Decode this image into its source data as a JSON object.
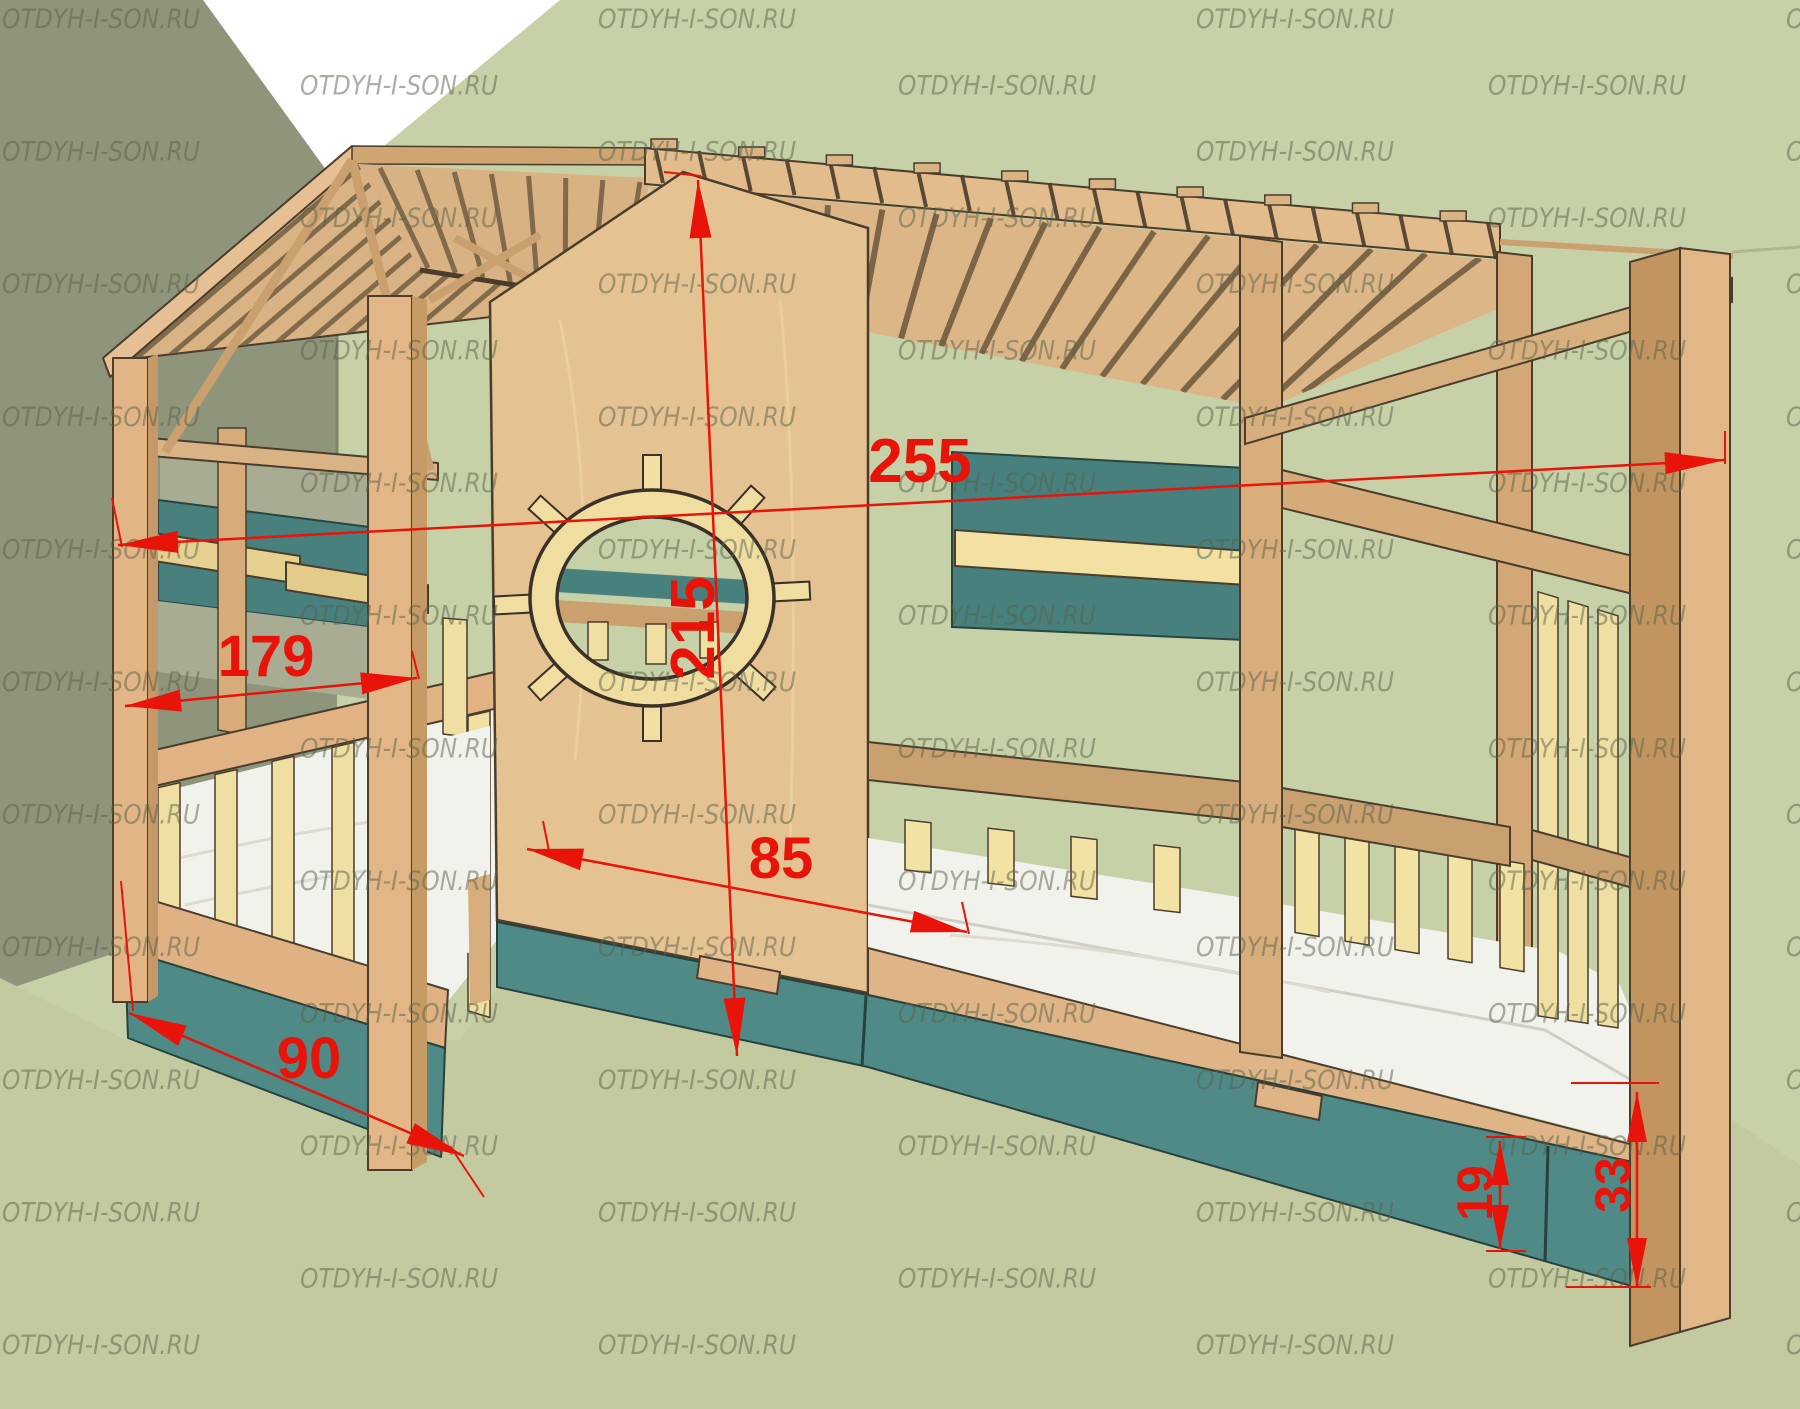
{
  "watermark": {
    "text": "OTDYH-I-SON.RU"
  },
  "dimensions": {
    "d255": "255",
    "d215": "215",
    "d179": "179",
    "d85": "85",
    "d90": "90",
    "d19": "19",
    "d33": "33"
  },
  "colors": {
    "dimension_red": "#e8140a",
    "wood_light": "#e5c292",
    "wood_mid": "#dcb485",
    "wood_beam": "#d5ab79",
    "wood_dark": "#c89c6a",
    "slat_yellow": "#f2e2a4",
    "teal_panel": "#47807d",
    "teal_drawer": "#4f8a86",
    "wall_left": "#8e957b",
    "wall_right": "#c6d1a8",
    "floor": "#c3caa0",
    "ceiling": "#ffffff",
    "mattress": "#f2f2ec",
    "watermark_text": "#5a624a",
    "outline": "#4a3d2c"
  }
}
